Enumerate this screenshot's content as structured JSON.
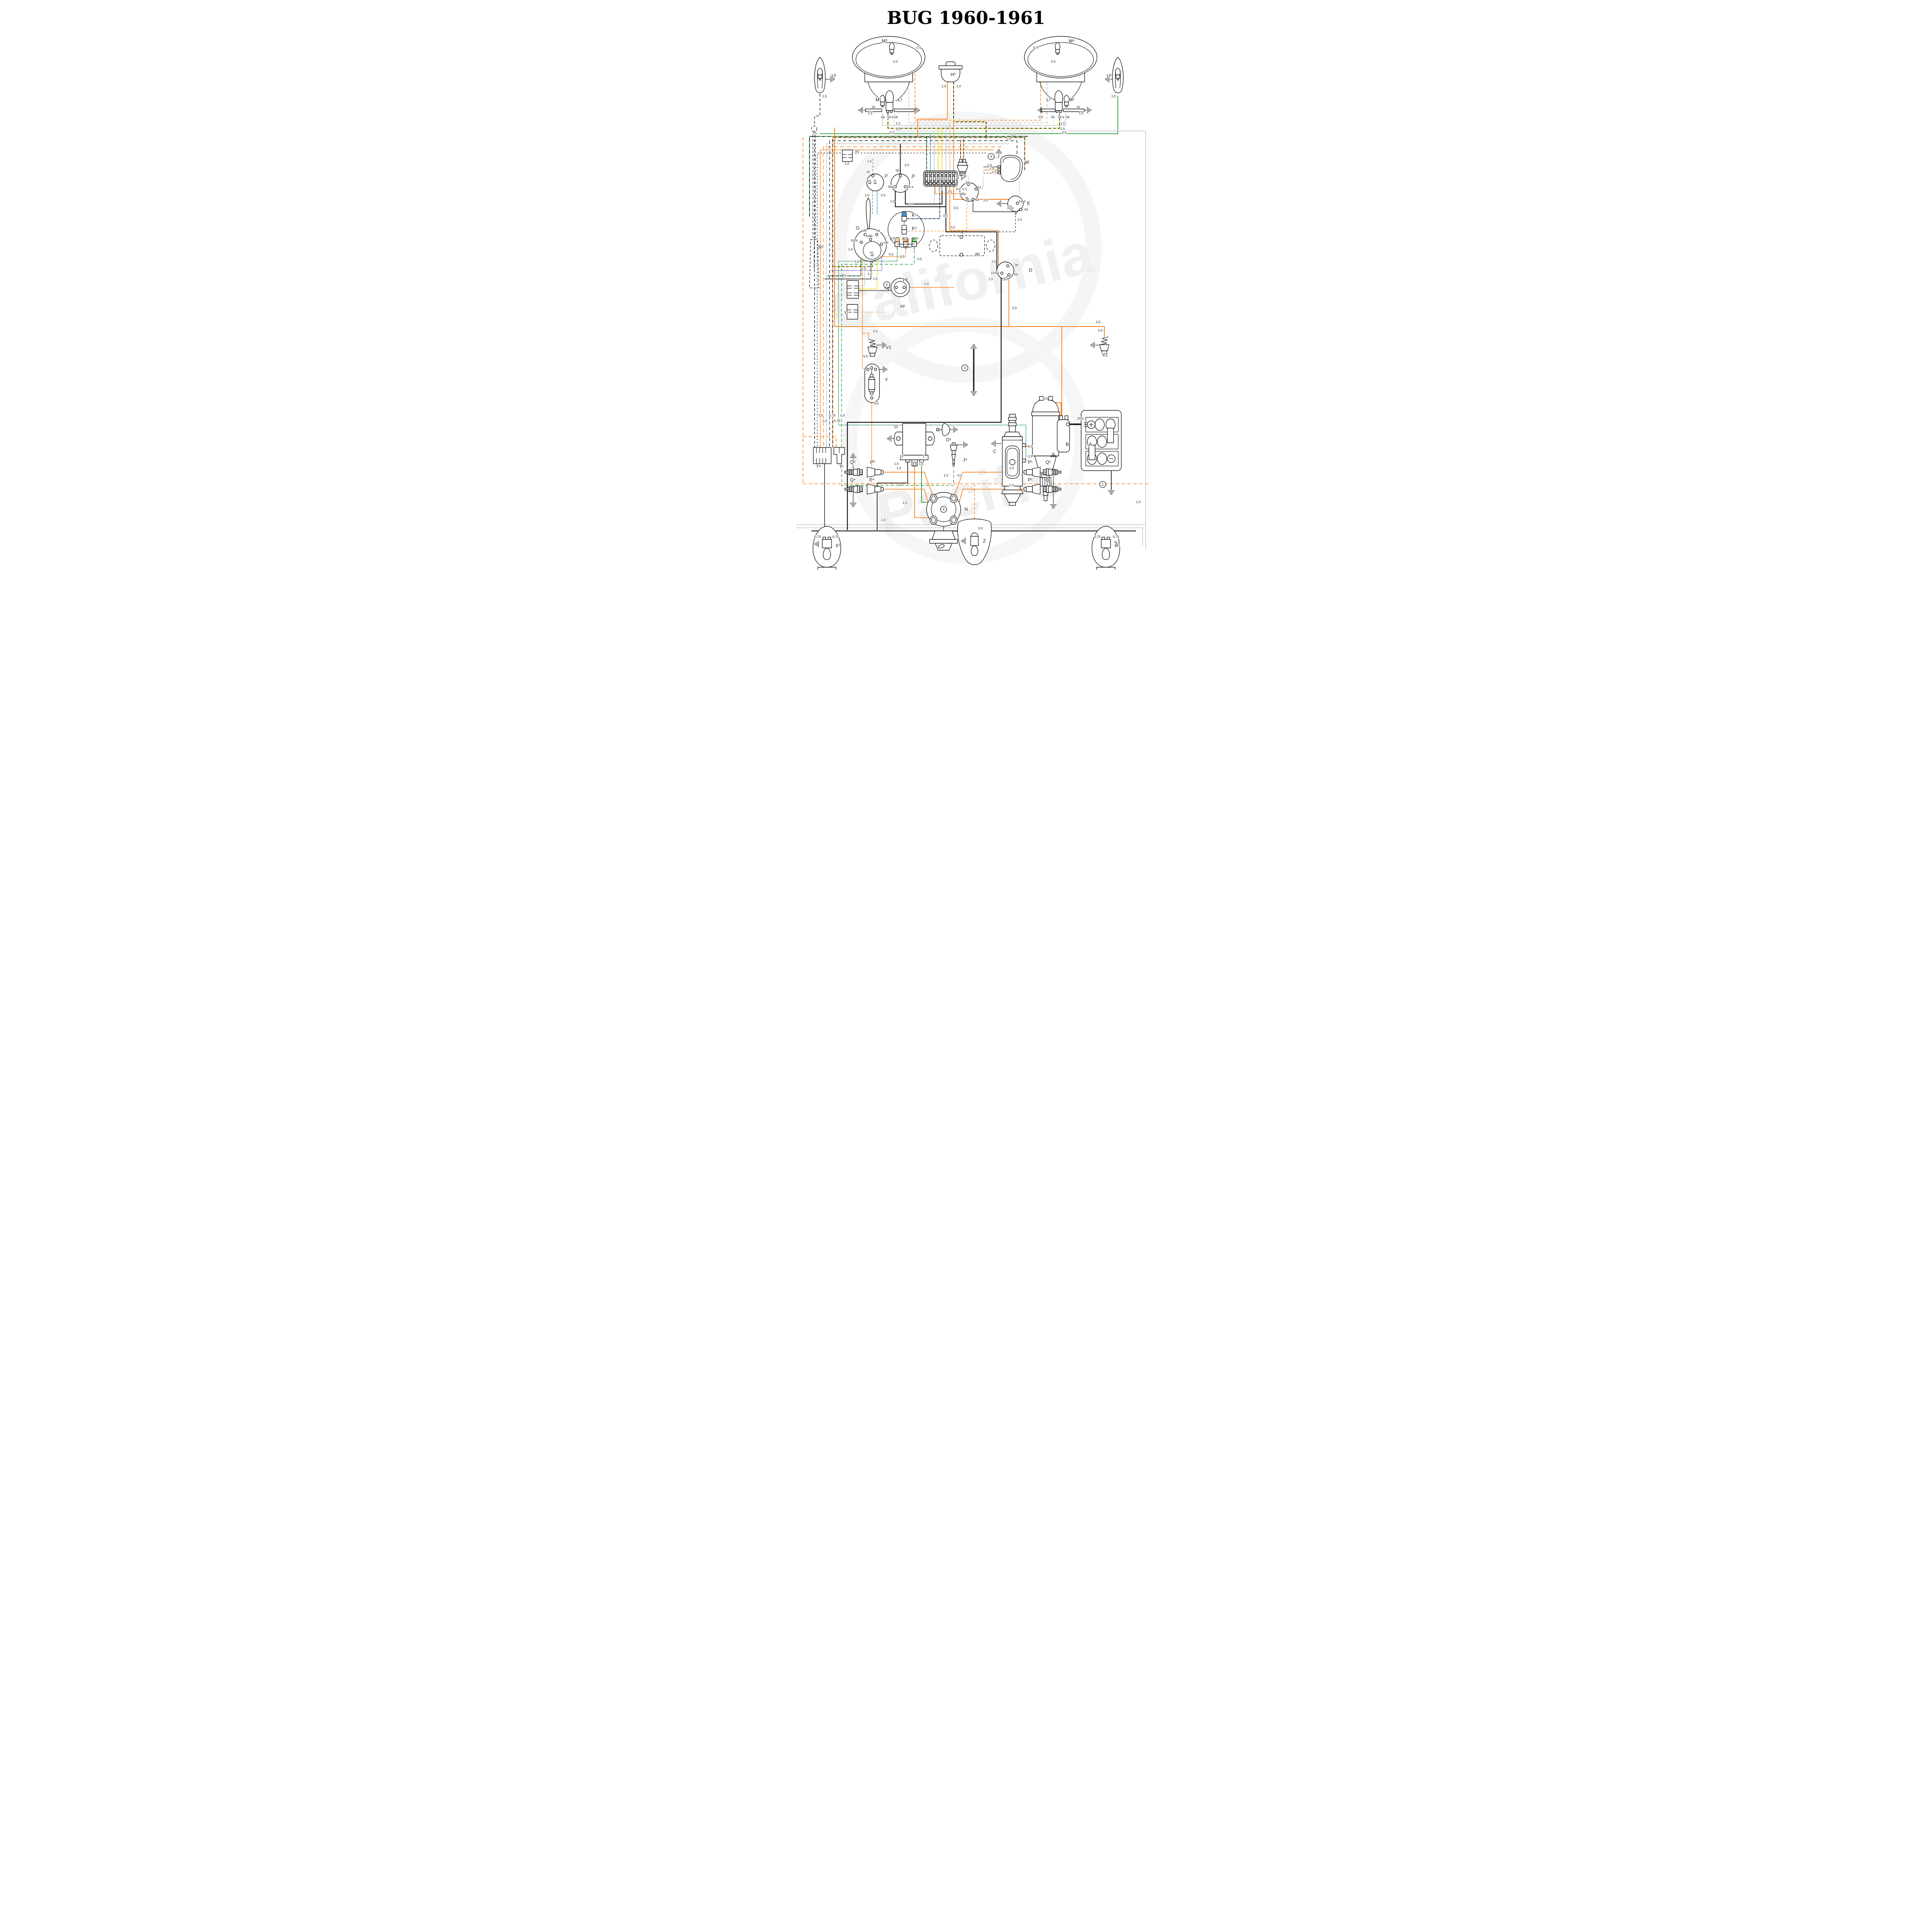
{
  "title": "BUG 1960-1961",
  "watermark": {
    "line1": "California",
    "line2": "Pacific",
    "color": "#f2f2f2"
  },
  "colors": {
    "bk": "#1a1a1a",
    "or": "#f5821f",
    "ye": "#eed202",
    "gn": "#1f9d38",
    "lg": "#7dd24a",
    "bl": "#4a90d9",
    "gy": "#c3c3c3",
    "wh": "#e4e4e4",
    "vi": "#9b7fd4"
  },
  "labels": [
    [
      "M³",
      282,
      110,
      12
    ],
    [
      "0.5",
      372,
      126,
      8.5
    ],
    [
      "0.5",
      312,
      162,
      8.5
    ],
    [
      "M¹",
      266,
      262,
      12
    ],
    [
      "L¹",
      324,
      262,
      12
    ],
    [
      "31",
      256,
      280,
      8.5
    ],
    [
      "1,5",
      246,
      296,
      8.5
    ],
    [
      "58",
      280,
      306,
      8.5
    ],
    [
      "56 b",
      296,
      306,
      8.5
    ],
    [
      "56",
      314,
      306,
      8.5
    ],
    [
      "U¹",
      152,
      200,
      12
    ],
    [
      "1,5",
      128,
      252,
      8.5
    ],
    [
      "H³",
      460,
      197,
      12
    ],
    [
      "1,0",
      437,
      226,
      8.5
    ],
    [
      "1,0",
      475,
      226,
      8.5
    ],
    [
      "M⁴",
      766,
      110,
      12
    ],
    [
      "0.5",
      674,
      126,
      8.5
    ],
    [
      "0.5",
      720,
      162,
      8.5
    ],
    [
      "L²",
      708,
      262,
      12
    ],
    [
      "M²",
      766,
      262,
      12
    ],
    [
      "31",
      786,
      280,
      8.5
    ],
    [
      "1,5",
      792,
      296,
      8.5
    ],
    [
      "56",
      720,
      306,
      8.5
    ],
    [
      "56 b",
      738,
      306,
      8.5
    ],
    [
      "58",
      758,
      306,
      8.5
    ],
    [
      "U²",
      864,
      200,
      12
    ],
    [
      "1,5",
      876,
      252,
      8.5
    ],
    [
      "1,5",
      318,
      322,
      8.5
    ],
    [
      "1,5",
      318,
      336,
      8.5
    ],
    [
      "0,5",
      303,
      346,
      8.5
    ],
    [
      "1,5",
      744,
      322,
      8.5
    ],
    [
      "1,5",
      744,
      336,
      8.5
    ],
    [
      "0,5",
      748,
      346,
      8.5
    ],
    [
      "1,5",
      102,
      348,
      8.5
    ],
    [
      "0,5",
      688,
      306,
      8.5
    ],
    [
      "1,0",
      616,
      350,
      8.5
    ],
    [
      "1,0",
      604,
      362,
      8.5
    ],
    [
      "T²",
      212,
      398,
      12
    ],
    [
      "1,0",
      186,
      426,
      8.5
    ],
    [
      "R²",
      118,
      644,
      12
    ],
    [
      "15",
      242,
      448,
      8.5
    ],
    [
      "J¹",
      288,
      459,
      12
    ],
    [
      "54",
      244,
      471,
      8.5
    ],
    [
      "K",
      262,
      471,
      8.5
    ],
    [
      "1,5",
      244,
      420,
      8.5
    ],
    [
      "1,0",
      238,
      508,
      8.5
    ],
    [
      "0,5",
      280,
      508,
      8.5
    ],
    [
      "56",
      318,
      444,
      8.5
    ],
    [
      "J²",
      358,
      460,
      12
    ],
    [
      "56 b",
      298,
      486,
      8.5
    ],
    [
      "56 a",
      347,
      486,
      8.5
    ],
    [
      "2,5",
      341,
      430,
      8.5
    ],
    [
      "2,5",
      304,
      524,
      8.5
    ],
    [
      "2,5",
      352,
      531,
      8.5
    ],
    [
      "S",
      474,
      462,
      12
    ],
    [
      "J³",
      491,
      462,
      12
    ],
    [
      "1,5",
      428,
      492,
      8.5
    ],
    [
      "2,5",
      452,
      499,
      8.5
    ],
    [
      "4,0",
      474,
      492,
      8.5
    ],
    [
      "1,5",
      490,
      492,
      8.5
    ],
    [
      "1,0",
      555,
      430,
      8.5
    ],
    [
      "1,0",
      561,
      439,
      8.5
    ],
    [
      "1,0",
      567,
      448,
      8.5
    ],
    [
      "W",
      652,
      424,
      12
    ],
    [
      "E",
      658,
      530,
      12
    ],
    [
      "31 b",
      606,
      541,
      8.5
    ],
    [
      "54 d",
      637,
      524,
      8.5
    ],
    [
      "54",
      651,
      545,
      8.5
    ],
    [
      "1,0",
      633,
      571,
      8.5
    ],
    [
      "F",
      487,
      467,
      12
    ],
    [
      "58",
      499,
      476,
      8.5
    ],
    [
      "57",
      530,
      488,
      8.5
    ],
    [
      "58 b",
      483,
      505,
      8.5
    ],
    [
      "30",
      499,
      519,
      8.5
    ],
    [
      "56",
      524,
      520,
      8.5
    ],
    [
      "2,5",
      545,
      521,
      8.5
    ],
    [
      "0,5",
      468,
      541,
      8.5
    ],
    [
      "K¹",
      360,
      561,
      12
    ],
    [
      "K⁵",
      360,
      595,
      12
    ],
    [
      "K²",
      303,
      622,
      12
    ],
    [
      "K³",
      335,
      622,
      12
    ],
    [
      "K⁴",
      364,
      622,
      12
    ],
    [
      "0,5",
      441,
      561,
      8.5
    ],
    [
      "0,5",
      460,
      591,
      8.5
    ],
    [
      "0,5",
      329,
      667,
      8.5
    ],
    [
      "0,5",
      374,
      673,
      8.5
    ],
    [
      "0,5",
      300,
      661,
      8.5
    ],
    [
      "G",
      215,
      594,
      12
    ],
    [
      "VR",
      231,
      600,
      8.5
    ],
    [
      "HL",
      268,
      600,
      8.5
    ],
    [
      "54St",
      202,
      625,
      8.5
    ],
    [
      "54Bl",
      241,
      614,
      8.5
    ],
    [
      "HR",
      287,
      631,
      8.5
    ],
    [
      "VL",
      251,
      657,
      8.5
    ],
    [
      "1,0",
      195,
      648,
      8.5
    ],
    [
      "1,0",
      212,
      680,
      8.5
    ],
    [
      "1,0",
      229,
      698,
      8.5
    ],
    [
      "1,0",
      245,
      712,
      8.5
    ],
    [
      "1,0",
      259,
      724,
      8.5
    ],
    [
      "T³",
      178,
      719,
      12
    ],
    [
      "T²",
      184,
      815,
      12
    ],
    [
      "H²",
      337,
      728,
      12
    ],
    [
      "H¹",
      330,
      797,
      12
    ],
    [
      "1,0",
      392,
      737,
      8.5
    ],
    [
      "R¹",
      524,
      663,
      12
    ],
    [
      "2,5",
      566,
      680,
      8.5
    ],
    [
      "30",
      626,
      689,
      8.5
    ],
    [
      "D",
      663,
      703,
      12
    ],
    [
      "15/54",
      564,
      709,
      8.5
    ],
    [
      "50",
      625,
      713,
      8.5
    ],
    [
      "1,5",
      558,
      725,
      8.5
    ],
    [
      "6,0",
      598,
      725,
      8.5
    ],
    [
      "2,5",
      620,
      800,
      8.5
    ],
    [
      "0,5",
      260,
      860,
      8.5
    ],
    [
      "V1",
      292,
      903,
      12
    ],
    [
      "0,5",
      234,
      925,
      8.5
    ],
    [
      "Y",
      290,
      987,
      12
    ],
    [
      "0,5",
      262,
      1047,
      8.5
    ],
    [
      "0,5",
      842,
      858,
      8.5
    ],
    [
      "V2",
      852,
      922,
      12
    ],
    [
      "2,5",
      836,
      836,
      8.5
    ],
    [
      "1,0",
      118,
      1078,
      8.5
    ],
    [
      "0,75",
      146,
      1078,
      8.5
    ],
    [
      "0,5",
      175,
      1078,
      8.5
    ],
    [
      "1,0",
      128,
      1092,
      8.5
    ],
    [
      "0,75",
      158,
      1092,
      8.5
    ],
    [
      "T³",
      112,
      1212,
      12
    ],
    [
      "T¹",
      172,
      1212,
      12
    ],
    [
      "O",
      314,
      1108,
      12
    ],
    [
      "15",
      328,
      1184,
      8.5
    ],
    [
      "1",
      388,
      1184,
      8.5
    ],
    [
      "1,5",
      314,
      1203,
      8.5
    ],
    [
      "1,5",
      378,
      1203,
      8.5
    ],
    [
      "O¹",
      448,
      1142,
      12
    ],
    [
      "J⁴",
      492,
      1194,
      12
    ],
    [
      "1,0",
      442,
      1233,
      8.5
    ],
    [
      "0,5",
      478,
      1233,
      8.5
    ],
    [
      "C",
      570,
      1172,
      12
    ],
    [
      "6,0",
      660,
      1158,
      8.5
    ],
    [
      "0,5",
      660,
      1184,
      8.5
    ],
    [
      "6,0",
      700,
      1034,
      8.5
    ],
    [
      "B",
      758,
      1154,
      12
    ],
    [
      "A",
      818,
      1154,
      12
    ],
    [
      "25,0",
      788,
      1086,
      8.5
    ],
    [
      "Q³",
      200,
      1200,
      12
    ],
    [
      "P³",
      252,
      1200,
      12
    ],
    [
      "1,0",
      320,
      1214,
      8.5
    ],
    [
      "Q⁴",
      200,
      1246,
      12
    ],
    [
      "P⁴",
      250,
      1246,
      12
    ],
    [
      "1,0",
      320,
      1258,
      8.5
    ],
    [
      "1,0",
      336,
      1304,
      8.5
    ],
    [
      "1,0",
      280,
      1348,
      8.5
    ],
    [
      "N",
      496,
      1322,
      12
    ],
    [
      "P¹",
      660,
      1200,
      12
    ],
    [
      "Q¹",
      706,
      1200,
      12
    ],
    [
      "1,0",
      612,
      1214,
      8.5
    ],
    [
      "P²",
      660,
      1246,
      12
    ],
    [
      "Q²",
      706,
      1246,
      12
    ],
    [
      "1,0",
      612,
      1258,
      8.5
    ],
    [
      "1,0",
      940,
      1302,
      8.5
    ],
    [
      "0,75",
      108,
      1392,
      8.5
    ],
    [
      "0,75",
      154,
      1392,
      8.5
    ],
    [
      "X¹",
      162,
      1416,
      12
    ],
    [
      "0,5",
      532,
      1370,
      8.5
    ],
    [
      "Z",
      544,
      1404,
      12
    ],
    [
      "0,75",
      832,
      1392,
      8.5
    ],
    [
      "0,75",
      880,
      1392,
      8.5
    ],
    [
      "X²",
      886,
      1416,
      12
    ]
  ],
  "wires": [
    [
      "M122,243 V300 H108 V1158",
      "bk",
      1.5,
      "7 5"
    ],
    [
      "M316,122 H368 V311",
      "or",
      1.6,
      "7 4"
    ],
    [
      "M308,150 V158 H352 V318",
      "gy",
      1.6,
      "7 4"
    ],
    [
      "M737,122 H693 V311",
      "or",
      1.6,
      "7 4"
    ],
    [
      "M745,150 V158 H710 V318",
      "gy",
      1.6,
      "7 4"
    ],
    [
      "M368,311 H693",
      "or",
      1.6,
      "7 4"
    ],
    [
      "M352,318 H710",
      "gy",
      1.6,
      "7 4"
    ],
    [
      "M284,292 V325 H758 V292",
      "gy",
      1.6
    ],
    [
      "M298,292 V332 H742 V292",
      "ye",
      1.8,
      null,
      "bk",
      "6 6"
    ],
    [
      "M314,292 V339 H726 V292",
      "wh",
      1.5
    ],
    [
      "M893,248 V346 H122",
      "gn",
      1.8
    ],
    [
      "M660,353 H95 V560",
      "gn",
      1.8,
      null,
      "bk",
      "8 7"
    ],
    [
      "M452,212 V308 H375 V356",
      "or",
      1.8
    ],
    [
      "M468,212 V315 H552 V360",
      "ye",
      1.8,
      null,
      "bk",
      "6 5"
    ],
    [
      "M652,440 V356 H155 V1158",
      "or",
      1.6,
      null,
      "bk",
      "7 6"
    ],
    [
      "M632,440 V364 H147 V1158",
      "bk",
      1.4,
      "8 6"
    ],
    [
      "M612,372 H139 V1158",
      "gy",
      1.4
    ],
    [
      "M592,380 H131 V1158",
      "or",
      1.4,
      "10 7"
    ],
    [
      "M572,388 H123 V1158",
      "or",
      1.4
    ],
    [
      "M552,396 H115 V1158",
      "bk",
      1.2,
      "4 4"
    ],
    [
      "M398,353 V444",
      "gn",
      1.5,
      null,
      "bk",
      "6 5"
    ],
    [
      "M408,346 V444",
      "bl",
      1.5
    ],
    [
      "M418,339 V444",
      "gy",
      1.5
    ],
    [
      "M428,332 V444",
      "ye",
      1.6
    ],
    [
      "M438,332 V444",
      "ye",
      1.6
    ],
    [
      "M448,325 V444",
      "gy",
      1.5
    ],
    [
      "M458,318 V444",
      "gy",
      1.5
    ],
    [
      "M468,311 V444",
      "or",
      1.6
    ],
    [
      "M486,418 V360",
      "or",
      1.4,
      null,
      "bk",
      "5 5"
    ],
    [
      "M494,418 V356",
      "or",
      1.4,
      null,
      "bk",
      "5 5"
    ],
    [
      "M418,480 V528",
      "gy",
      1.5
    ],
    [
      "M448,480 V600 H580 V709 H591",
      "bk",
      2.2
    ],
    [
      "M468,480 V516 H628 V549",
      "or",
      2.2
    ],
    [
      "M458,480 V596 H584 V688 H596",
      "or",
      1.8
    ],
    [
      "M317,483 V535 H448",
      "bk",
      2.2
    ],
    [
      "M343,483 V528 H438 V480",
      "bk",
      2.2
    ],
    [
      "M330,450 V372",
      "bk",
      2
    ],
    [
      "M259,452 V410",
      "gn",
      1.3,
      "5 4"
    ],
    [
      "M258,494 V556",
      "gn",
      1.3,
      "5 4"
    ],
    [
      "M270,494 V556",
      "bl",
      1.3
    ],
    [
      "M348,566 H432 V480",
      "bl",
      1.4,
      null,
      "bk",
      "6 5"
    ],
    [
      "M348,598 H502 V517",
      "or",
      1.3,
      "6 4"
    ],
    [
      "M322,648 V676 H170 V1100 H655 V1192 H650",
      "bl",
      1.5,
      null,
      "lg",
      "10 8"
    ],
    [
      "M344,648 V664 H232 V862 H248 V876",
      "or",
      1.3
    ],
    [
      "M232,862 V953 H240",
      "or",
      1.3
    ],
    [
      "M366,648 V684 H178 V1256 H468 V1206",
      "gn",
      1.4,
      "8 5"
    ],
    [
      "M258,664 V690 H157",
      "ye",
      1.4,
      null,
      "bk",
      "6 5"
    ],
    [
      "M282,636 V700 H150",
      "vi",
      1.4
    ],
    [
      "M228,630 V714 H142",
      "gn",
      1.4,
      null,
      "bk",
      "6 5"
    ],
    [
      "M254,622 V722 H134",
      "bk",
      1.4
    ],
    [
      "M238,610 V740 H222",
      "gy",
      1.4
    ],
    [
      "M270,610 V748 H222",
      "ye",
      1.4
    ],
    [
      "M222,752 H310 V744 H316",
      "bk",
      1.3
    ],
    [
      "M338,744 H470",
      "or",
      1.5
    ],
    [
      "M220,808 H300",
      "or",
      1,
      "3 3"
    ],
    [
      "M611,712 V845",
      "or",
      1.8
    ],
    [
      "M160,330 V845 H858 V872",
      "or",
      2
    ],
    [
      "M748,845 V1086",
      "or",
      1.8
    ],
    [
      "M256,1032 V1252",
      "or",
      1.3
    ],
    [
      "M78,1252 H975",
      "or",
      1.6,
      "9 6"
    ],
    [
      "M78,355 V1252",
      "or",
      1.6,
      "9 6"
    ],
    [
      "M78,1130 H164 V1158",
      "or",
      1.6,
      "9 6"
    ],
    [
      "M60,1358 H965 V1420",
      "gy",
      1.5
    ],
    [
      "M60,1366 H957 V1412",
      "gy",
      1.5
    ],
    [
      "M750,339 H965 V1358",
      "gy",
      1.5
    ],
    [
      "M100,1374 H940",
      "bk",
      2.2
    ],
    [
      "M134,1200 V1390",
      "bk",
      1.5
    ],
    [
      "M146,1366 V1390",
      "gy",
      1.4
    ],
    [
      "M854,1366 V1390",
      "gy",
      1.4
    ],
    [
      "M866,1358 V1390",
      "gy",
      1.4
    ],
    [
      "M522,1252 V1386",
      "or",
      1.4,
      "7 5"
    ],
    [
      "M349,1196 V1250 H270 V1372",
      "bk",
      1.8
    ],
    [
      "M385,1196 V1300 H404",
      "gn",
      1.8
    ],
    [
      "M367,1206 V1340 H406",
      "or",
      1.8
    ],
    [
      "M282,1222 H392 L416,1288",
      "or",
      1.8
    ],
    [
      "M280,1266 H392 L414,1342",
      "or",
      1.8
    ],
    [
      "M656,1222 H492 L468,1288",
      "or",
      1.8
    ],
    [
      "M656,1266 H492 L470,1342",
      "or",
      1.8
    ],
    [
      "M650,1155 H692 V1042 H746 V1082",
      "or",
      2.2
    ],
    [
      "M628,549 V600 H490 V609",
      "bk",
      1.2,
      "5 4"
    ],
    [
      "M484,501 H420 V481",
      "or",
      1.6
    ],
    [
      "M524,487 H544 V458",
      "gy",
      1.4
    ],
    [
      "M506,473 V452",
      "gy",
      1.2
    ],
    [
      "M518,518 V548 H626",
      "bk",
      1.4
    ],
    [
      "M585,432 H545",
      "bk",
      1.2
    ],
    [
      "M585,440 H545",
      "or",
      1.4
    ],
    [
      "M585,448 H545",
      "bk",
      1.2,
      "5 4"
    ],
    [
      "M638,470 V506",
      "vi",
      1.2,
      "3 3"
    ],
    [
      "M591,712 V1093 H193 V1372",
      "bk",
      2.4
    ],
    [
      "M768,1098 H813",
      "bk",
      4
    ],
    [
      "M876,1198 V1268",
      "bk",
      1.8
    ],
    [
      "M572,408 H584",
      "bk",
      1.2,
      "2 3"
    ],
    [
      "M585,407 V399",
      "bk",
      1.2
    ],
    [
      "M302,744 H316",
      "bk",
      1.2,
      "2 3"
    ],
    [
      "M592,527 H610",
      "bk",
      1.2
    ],
    [
      "M308,1135 H322",
      "bk",
      1.2
    ],
    [
      "M578,1148 H592",
      "bk",
      1.2
    ],
    [
      "M476,1151 H492",
      "bk",
      1.2
    ],
    [
      "M450,1112 H466",
      "bk",
      1.2
    ],
    [
      "M268,893 H282",
      "bk",
      1.2
    ],
    [
      "M846,893 H834",
      "bk",
      1.2
    ],
    [
      "M266,956 H284",
      "bk",
      1.2
    ],
    [
      "M726,1213 V1184",
      "bk",
      1.2
    ],
    [
      "M726,1231 V1304",
      "bk",
      1.2
    ],
    [
      "M208,1213 V1186",
      "bk",
      1.2
    ],
    [
      "M208,1275 V1300",
      "bk",
      1.2
    ],
    [
      "M120,1408 H128",
      "bk",
      1.2
    ],
    [
      "M874,1408 H884",
      "bk",
      1.2
    ],
    [
      "M500,1400 H510",
      "bk",
      1.2
    ],
    [
      "M131,205 H148",
      "bk",
      1.2
    ],
    [
      "M884,205 H872",
      "bk",
      1.2
    ],
    [
      "M240,285 H234",
      "bk",
      1.2
    ],
    [
      "M318,285 H366",
      "or",
      1.4,
      "2 3"
    ],
    [
      "M731,285 H698",
      "or",
      1.4,
      "2 3"
    ],
    [
      "M806,285 H812",
      "bk",
      1.2
    ],
    [
      "M520,903 V1012",
      "bk",
      3.5
    ]
  ],
  "grounds": [
    [
      232,
      285,
      180
    ],
    [
      370,
      285,
      0
    ],
    [
      150,
      205,
      0
    ],
    [
      870,
      205,
      180
    ],
    [
      696,
      285,
      180
    ],
    [
      814,
      285,
      0
    ],
    [
      585,
      396,
      -90
    ],
    [
      590,
      527,
      180
    ],
    [
      300,
      744,
      180
    ],
    [
      284,
      893,
      0
    ],
    [
      832,
      893,
      180
    ],
    [
      286,
      956,
      0
    ],
    [
      520,
      901,
      -90
    ],
    [
      520,
      1014,
      90
    ],
    [
      306,
      1135,
      180
    ],
    [
      468,
      1112,
      0
    ],
    [
      494,
      1151,
      0
    ],
    [
      576,
      1148,
      180
    ],
    [
      726,
      1182,
      -90
    ],
    [
      726,
      1306,
      90
    ],
    [
      208,
      1184,
      -90
    ],
    [
      208,
      1302,
      90
    ],
    [
      876,
      1270,
      90
    ],
    [
      118,
      1408,
      180
    ],
    [
      886,
      1408,
      0
    ],
    [
      498,
      1400,
      180
    ]
  ],
  "callouts": [
    [
      854,
      1254,
      "1"
    ],
    [
      295,
      737,
      "2"
    ],
    [
      497,
      952,
      "3"
    ],
    [
      565,
      405,
      "4"
    ],
    [
      442,
      1318,
      "4"
    ]
  ]
}
